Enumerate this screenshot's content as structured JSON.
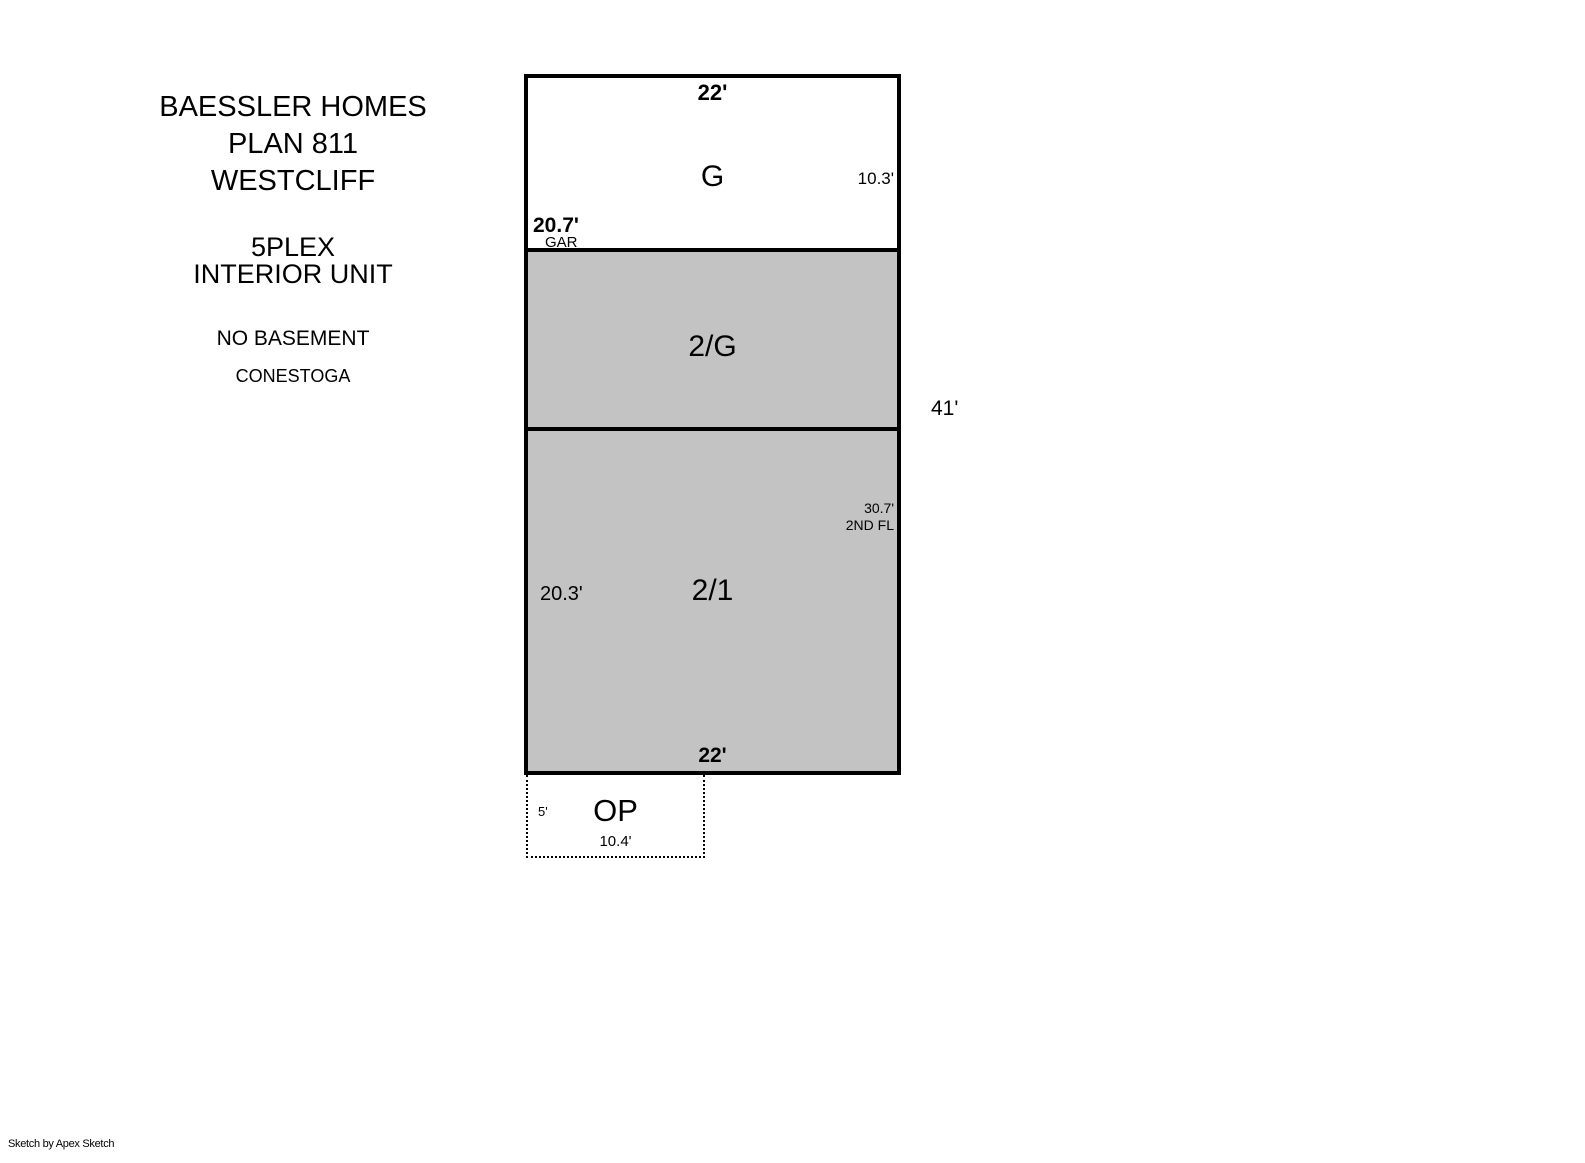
{
  "title_block": {
    "line1": "BAESSLER HOMES",
    "line2": "PLAN 811",
    "line3": "WESTCLIFF",
    "line4": "5PLEX",
    "line5": "INTERIOR UNIT",
    "line6": "NO BASEMENT",
    "line7": "CONESTOGA"
  },
  "plan": {
    "garage_section": {
      "label": "G",
      "top_width": "22'",
      "right_depth": "10.3'",
      "left_depth": "20.7'",
      "left_depth_sublabel": "GAR"
    },
    "second_floor_over_garage_section": {
      "label": "2/G"
    },
    "two_story_section": {
      "label": "2/1",
      "left_depth": "20.3'",
      "right_depth": "30.7'",
      "right_depth_sublabel": "2ND FL",
      "bottom_width": "22'"
    },
    "overall_right_depth": "41'"
  },
  "porch": {
    "label": "OP",
    "left_depth": "5'",
    "bottom_width": "10.4'"
  },
  "footer": {
    "credit": "Sketch by Apex Sketch"
  },
  "colors": {
    "section_fill": "#c3c3c3",
    "line": "#000000",
    "canvas": "#ffffff"
  }
}
